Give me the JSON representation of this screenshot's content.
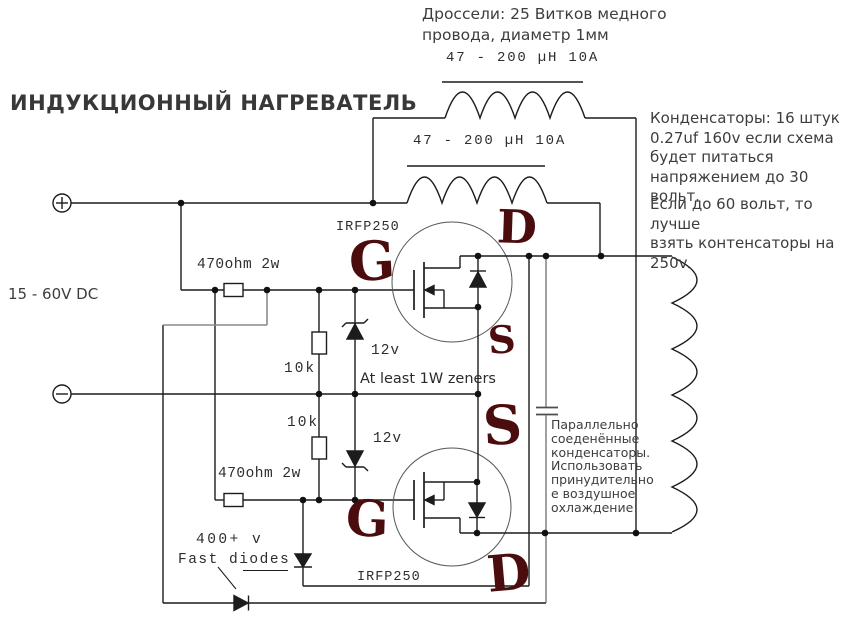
{
  "title": "ИНДУКЦИОННЫЙ НАГРЕВАТЕЛЬ",
  "colors": {
    "wire": "#1c1c1c",
    "gray_wire": "#8a8a8a",
    "handwriting": "#4a0c0c",
    "text": "#3d3d3d"
  },
  "notes": {
    "chokes": "Дроссели: 25 Витков медного\nпровода, диаметр 1мм",
    "capacitors_main": "Конденсаторы: 16 штук\n0.27uf 160v если схема\nбудет питаться\nнапряжением до 30 вольт.",
    "capacitors_alt": "Если до 60 вольт, то лучше\nвзять контенсаторы на\n250v.",
    "parallel_caps": "Параллельно\nсоеденённые\nконденсаторы.\nИспользовать\nпринудительно\nе воздушное\nохлаждение!",
    "zeners": "At least 1W zeners",
    "fast_diodes_voltage": "400+ v",
    "fast_diodes": "Fast diodes"
  },
  "supply": {
    "label": "15 - 60V DC"
  },
  "components": {
    "choke1": "47 - 200 µH 10A",
    "choke2": "47 - 200 µH 10A",
    "r_gate_top": "470ohm 2w",
    "r_gate_bottom": "470ohm 2w",
    "r_pulldown_top": "10k",
    "r_pulldown_bottom": "10k",
    "zener_top": "12v",
    "zener_bottom": "12v",
    "mosfet_top": "IRFP250",
    "mosfet_bottom": "IRFP250"
  },
  "pins": {
    "q1_gate": "G",
    "q1_drain": "D",
    "q1_source": "S",
    "q2_source": "S",
    "q2_gate": "G",
    "q2_drain": "D"
  }
}
